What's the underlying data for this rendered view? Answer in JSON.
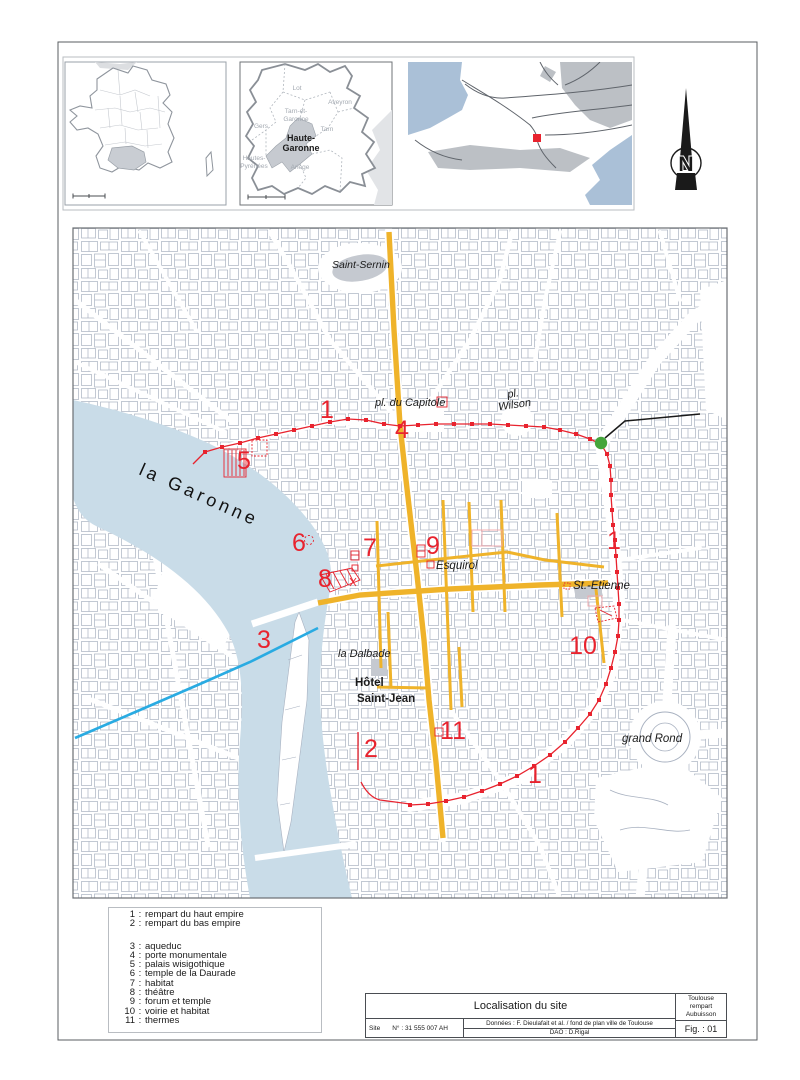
{
  "compass": {
    "letter": "N"
  },
  "insets": {
    "region": {
      "labels": {
        "lot": "Lot",
        "aveyron": "Aveyron",
        "tarn_garonne_1": "Tarn-et-",
        "tarn_garonne_2": "Garonne",
        "tarn": "Tarn",
        "gers": "Gers",
        "haute_garonne_1": "Haute-",
        "haute_garonne_2": "Garonne",
        "hautes_pyrenees_1": "Hautes-",
        "hautes_pyrenees_2": "Pyrénées",
        "ariege": "Ariège"
      }
    }
  },
  "map": {
    "labels": {
      "saint_sernin": "Saint-Sernin",
      "pl_du_capitole": "pl. du Capitole",
      "pl_wilson_1": "pl.",
      "pl_wilson_2": "Wilson",
      "la_garonne": "la Garonne",
      "esquirol": "Esquirol",
      "st_etienne": "St.-Etienne",
      "la_dalbade": "la Dalbade",
      "hotel_1": "Hôtel",
      "hotel_2": "Saint-Jean",
      "grand_rond": "grand Rond"
    },
    "numbers": {
      "n1a": "1",
      "n1b": "1",
      "n1c": "1",
      "n2": "2",
      "n3": "3",
      "n4": "4",
      "n5": "5",
      "n6": "6",
      "n7": "7",
      "n8": "8",
      "n9": "9",
      "n10": "10",
      "n11": "11"
    },
    "colors": {
      "road": "#efb32a",
      "rampart": "#e8232e",
      "aqueduct": "#29abe2",
      "site_marker": "#45a53b",
      "river": "#c9dce8",
      "buildings": "#a9b2c1"
    }
  },
  "legend": {
    "separator": ":",
    "items": [
      {
        "num": "1",
        "label": "rempart du haut empire"
      },
      {
        "num": "2",
        "label": "rempart du bas empire"
      },
      {
        "num": "3",
        "label": "aqueduc"
      },
      {
        "num": "4",
        "label": "porte monumentale"
      },
      {
        "num": "5",
        "label": "palais wisigothique"
      },
      {
        "num": "6",
        "label": "temple de la Daurade"
      },
      {
        "num": "7",
        "label": "habitat"
      },
      {
        "num": "8",
        "label": "théâtre"
      },
      {
        "num": "9",
        "label": "forum et temple"
      },
      {
        "num": "10",
        "label": "voirie et habitat"
      },
      {
        "num": "11",
        "label": "thermes"
      }
    ]
  },
  "title_block": {
    "title": "Localisation du site",
    "site_label": "Site",
    "site_number": "N° : 31 555 007 AH",
    "credits_line1": "Données : F. Dieulafait et al. /  fond de plan ville de Toulouse",
    "credits_line2": "DAO : D.Rigal",
    "city": "Toulouse",
    "site_name": "rempart Aubuisson",
    "figure": "Fig. : 01"
  }
}
